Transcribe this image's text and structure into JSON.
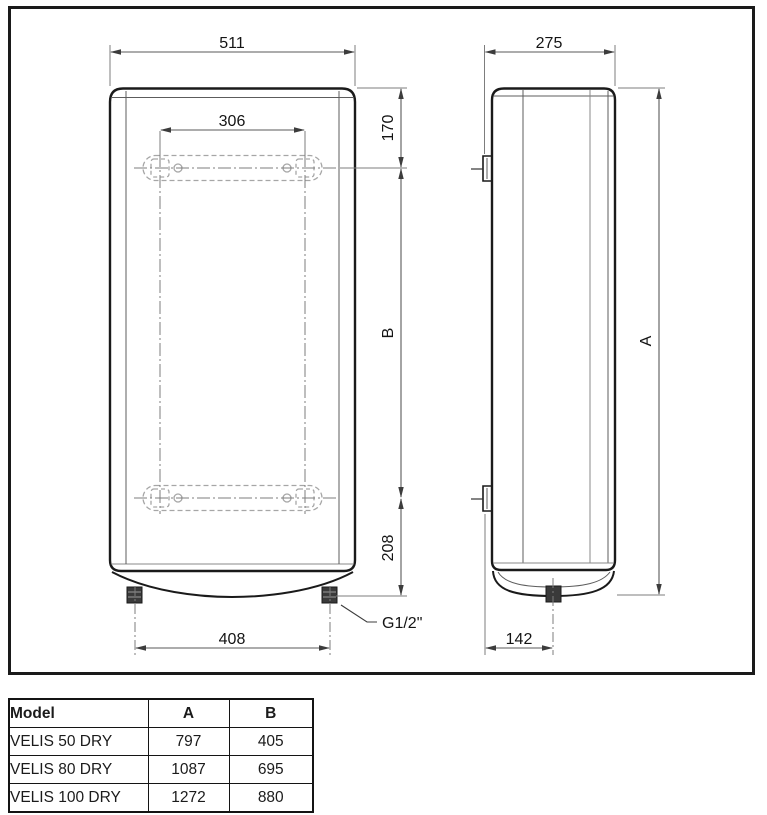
{
  "drawing": {
    "front": {
      "width": "511",
      "bracket_spacing": "306",
      "top_to_bracket": "170",
      "bracket_span": "B",
      "bracket_to_bottom": "208",
      "pipe_spacing": "408",
      "pipe_thread": "G1/2\""
    },
    "side": {
      "depth": "275",
      "height": "A",
      "pipe_offset": "142"
    }
  },
  "table": {
    "headers": [
      "Model",
      "A",
      "B"
    ],
    "rows": [
      {
        "model": "VELIS 50 DRY",
        "a": "797",
        "b": "405"
      },
      {
        "model": "VELIS 80 DRY",
        "a": "1087",
        "b": "695"
      },
      {
        "model": "VELIS 100 DRY",
        "a": "1272",
        "b": "880"
      }
    ]
  },
  "colors": {
    "line": "#1a1a1a",
    "dimension": "#5a5a5a",
    "hidden_line": "#a6a6a6",
    "background": "#ffffff"
  }
}
